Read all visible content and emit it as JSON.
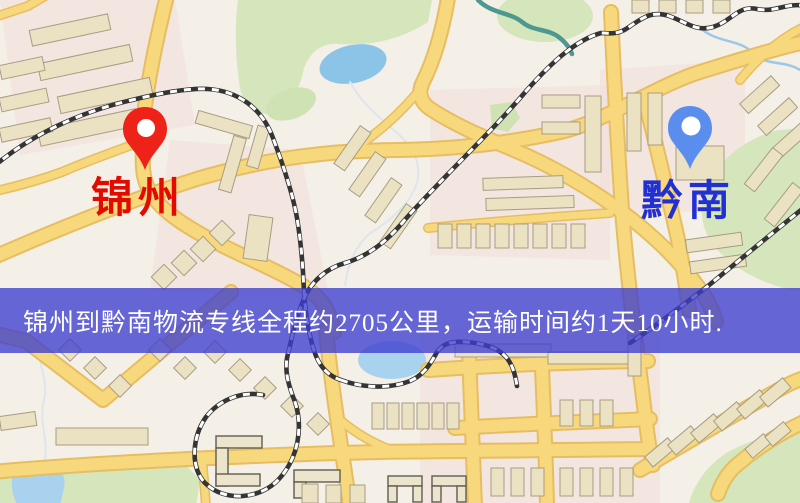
{
  "map": {
    "origin": {
      "label": "锦州",
      "marker_color": "#ee2218",
      "label_color": "#e30b00"
    },
    "destination": {
      "label": "黔南",
      "marker_color": "#5b8def",
      "label_color": "#2230d2"
    },
    "caption": {
      "text": "锦州到黔南物流专线全程约2705公里，运输时间约1天10小时.",
      "distance_km": "2705",
      "duration": "1天10小时",
      "background_color": "#3e3ed0",
      "text_color": "#ffffff"
    },
    "palette": {
      "background": "#f4efe7",
      "road": "#f7d87c",
      "road_casing": "#e7bd62",
      "park": "#d5e6bd",
      "water": "#8cc4e8",
      "building": "#ebe2c4",
      "railway": "#343434"
    }
  }
}
